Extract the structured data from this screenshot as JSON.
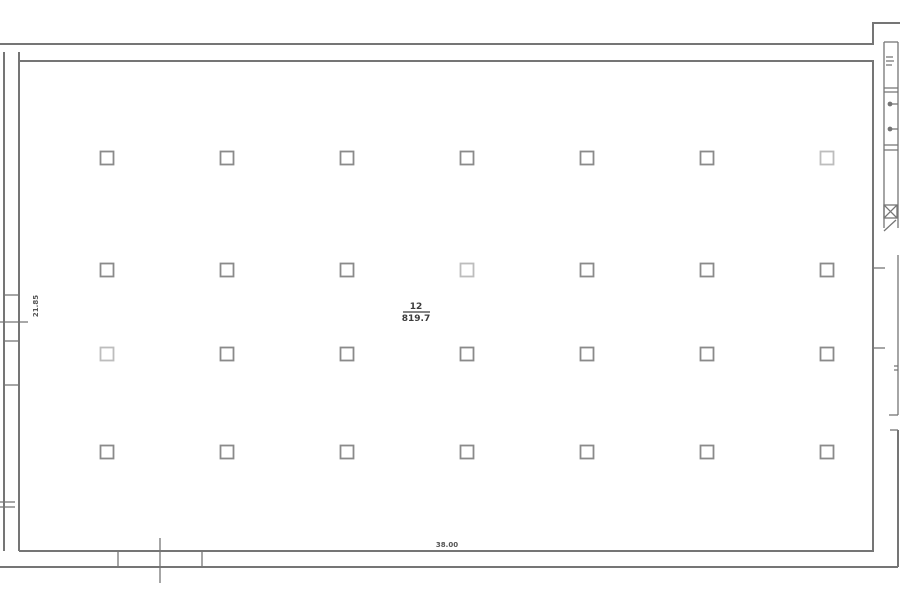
{
  "plan": {
    "room": {
      "number": "12",
      "area": "819.7"
    },
    "dimensions": {
      "horizontal": "38.00",
      "vertical": "21.85"
    },
    "colors": {
      "background": "#fdfdfd",
      "wall": "#757575",
      "column": "#8a8a8a",
      "column_faded": "#bdbdbd",
      "text": "#3c3c3c"
    },
    "grid": {
      "size": 13,
      "column_centers_x": [
        107,
        227,
        347,
        467,
        587,
        707,
        827
      ],
      "row_centers_y": [
        158,
        270,
        354,
        452
      ],
      "faded": [
        {
          "row": 0,
          "col": 6
        },
        {
          "row": 1,
          "col": 3
        },
        {
          "row": 2,
          "col": 0
        }
      ]
    }
  }
}
